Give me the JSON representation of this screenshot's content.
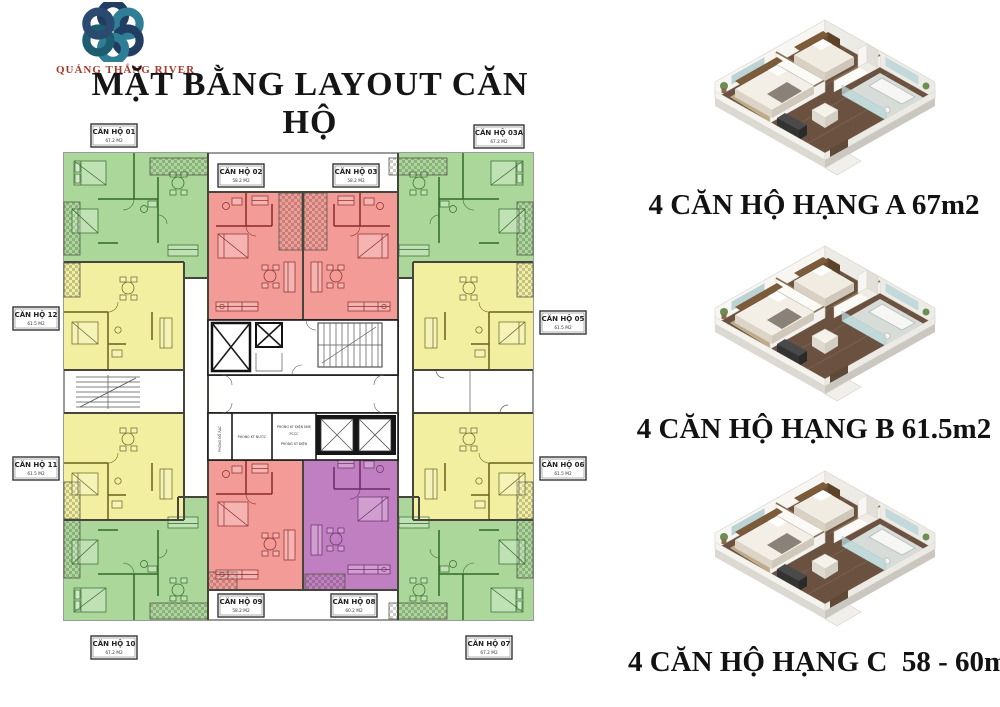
{
  "logo": {
    "text": "QUẢNG THẮNG RIVER",
    "icon": "flower-rings-logo"
  },
  "title": "MẶT BẰNG LAYOUT CĂN HỘ",
  "floor_plan": {
    "apartments": [
      {
        "id": "01",
        "label": "CĂN HỘ 01",
        "area": "67.2 M2",
        "type": "A",
        "color": "#abd79b"
      },
      {
        "id": "02",
        "label": "CĂN HỘ 02",
        "area": "58.2 M2",
        "type": "C",
        "color": "#f29b97"
      },
      {
        "id": "03",
        "label": "CĂN HỘ 03",
        "area": "58.2 M2",
        "type": "C",
        "color": "#f29b97"
      },
      {
        "id": "03A",
        "label": "CĂN HỘ 03A",
        "area": "67.2 M2",
        "type": "A",
        "color": "#abd79b"
      },
      {
        "id": "05",
        "label": "CĂN HỘ 05",
        "area": "61.5 M2",
        "type": "B",
        "color": "#f2efa0"
      },
      {
        "id": "06",
        "label": "CĂN HỘ 06",
        "area": "61.5 M2",
        "type": "B",
        "color": "#f2efa0"
      },
      {
        "id": "07",
        "label": "CĂN HỘ 07",
        "area": "67.2 M2",
        "type": "A",
        "color": "#abd79b"
      },
      {
        "id": "08",
        "label": "CĂN HỘ 08",
        "area": "60.2 M2",
        "type": "C",
        "color": "#c07fc0"
      },
      {
        "id": "09",
        "label": "CĂN HỘ 09",
        "area": "58.2 M2",
        "type": "C",
        "color": "#f29b97"
      },
      {
        "id": "10",
        "label": "CĂN HỘ 10",
        "area": "67.2 M2",
        "type": "A",
        "color": "#abd79b"
      },
      {
        "id": "11",
        "label": "CĂN HỘ 11",
        "area": "61.5 M2",
        "type": "B",
        "color": "#f2efa0"
      },
      {
        "id": "12",
        "label": "CĂN HỘ 12",
        "area": "61.5 M2",
        "type": "B",
        "color": "#f2efa0"
      }
    ],
    "core_rooms": {
      "trash": "PHÒNG ĐỔ RÁC",
      "water": "PHÒNG KT NƯỚC",
      "low_voltage": "PHÒNG KT ĐIỆN NHẸ",
      "fire": "PCCC",
      "electric": "PHÒNG KT ĐIỆN"
    }
  },
  "unit_types": [
    {
      "class": "A",
      "caption": "4 CĂN HỘ HẠNG A 67m2"
    },
    {
      "class": "B",
      "caption": "4 CĂN HỘ HẠNG B 61.5m2"
    },
    {
      "class": "C",
      "caption": "4 CĂN HỘ HẠNG C  58 - 60m2"
    }
  ],
  "colors": {
    "type_a_green": "#abd79b",
    "type_b_yellow": "#f2efa0",
    "type_c_red": "#f29b97",
    "type_c_purple": "#c07fc0",
    "logo_text_red": "#a9392b",
    "logo_ring_teal": "#2e7f95",
    "logo_ring_navy": "#223d62"
  }
}
